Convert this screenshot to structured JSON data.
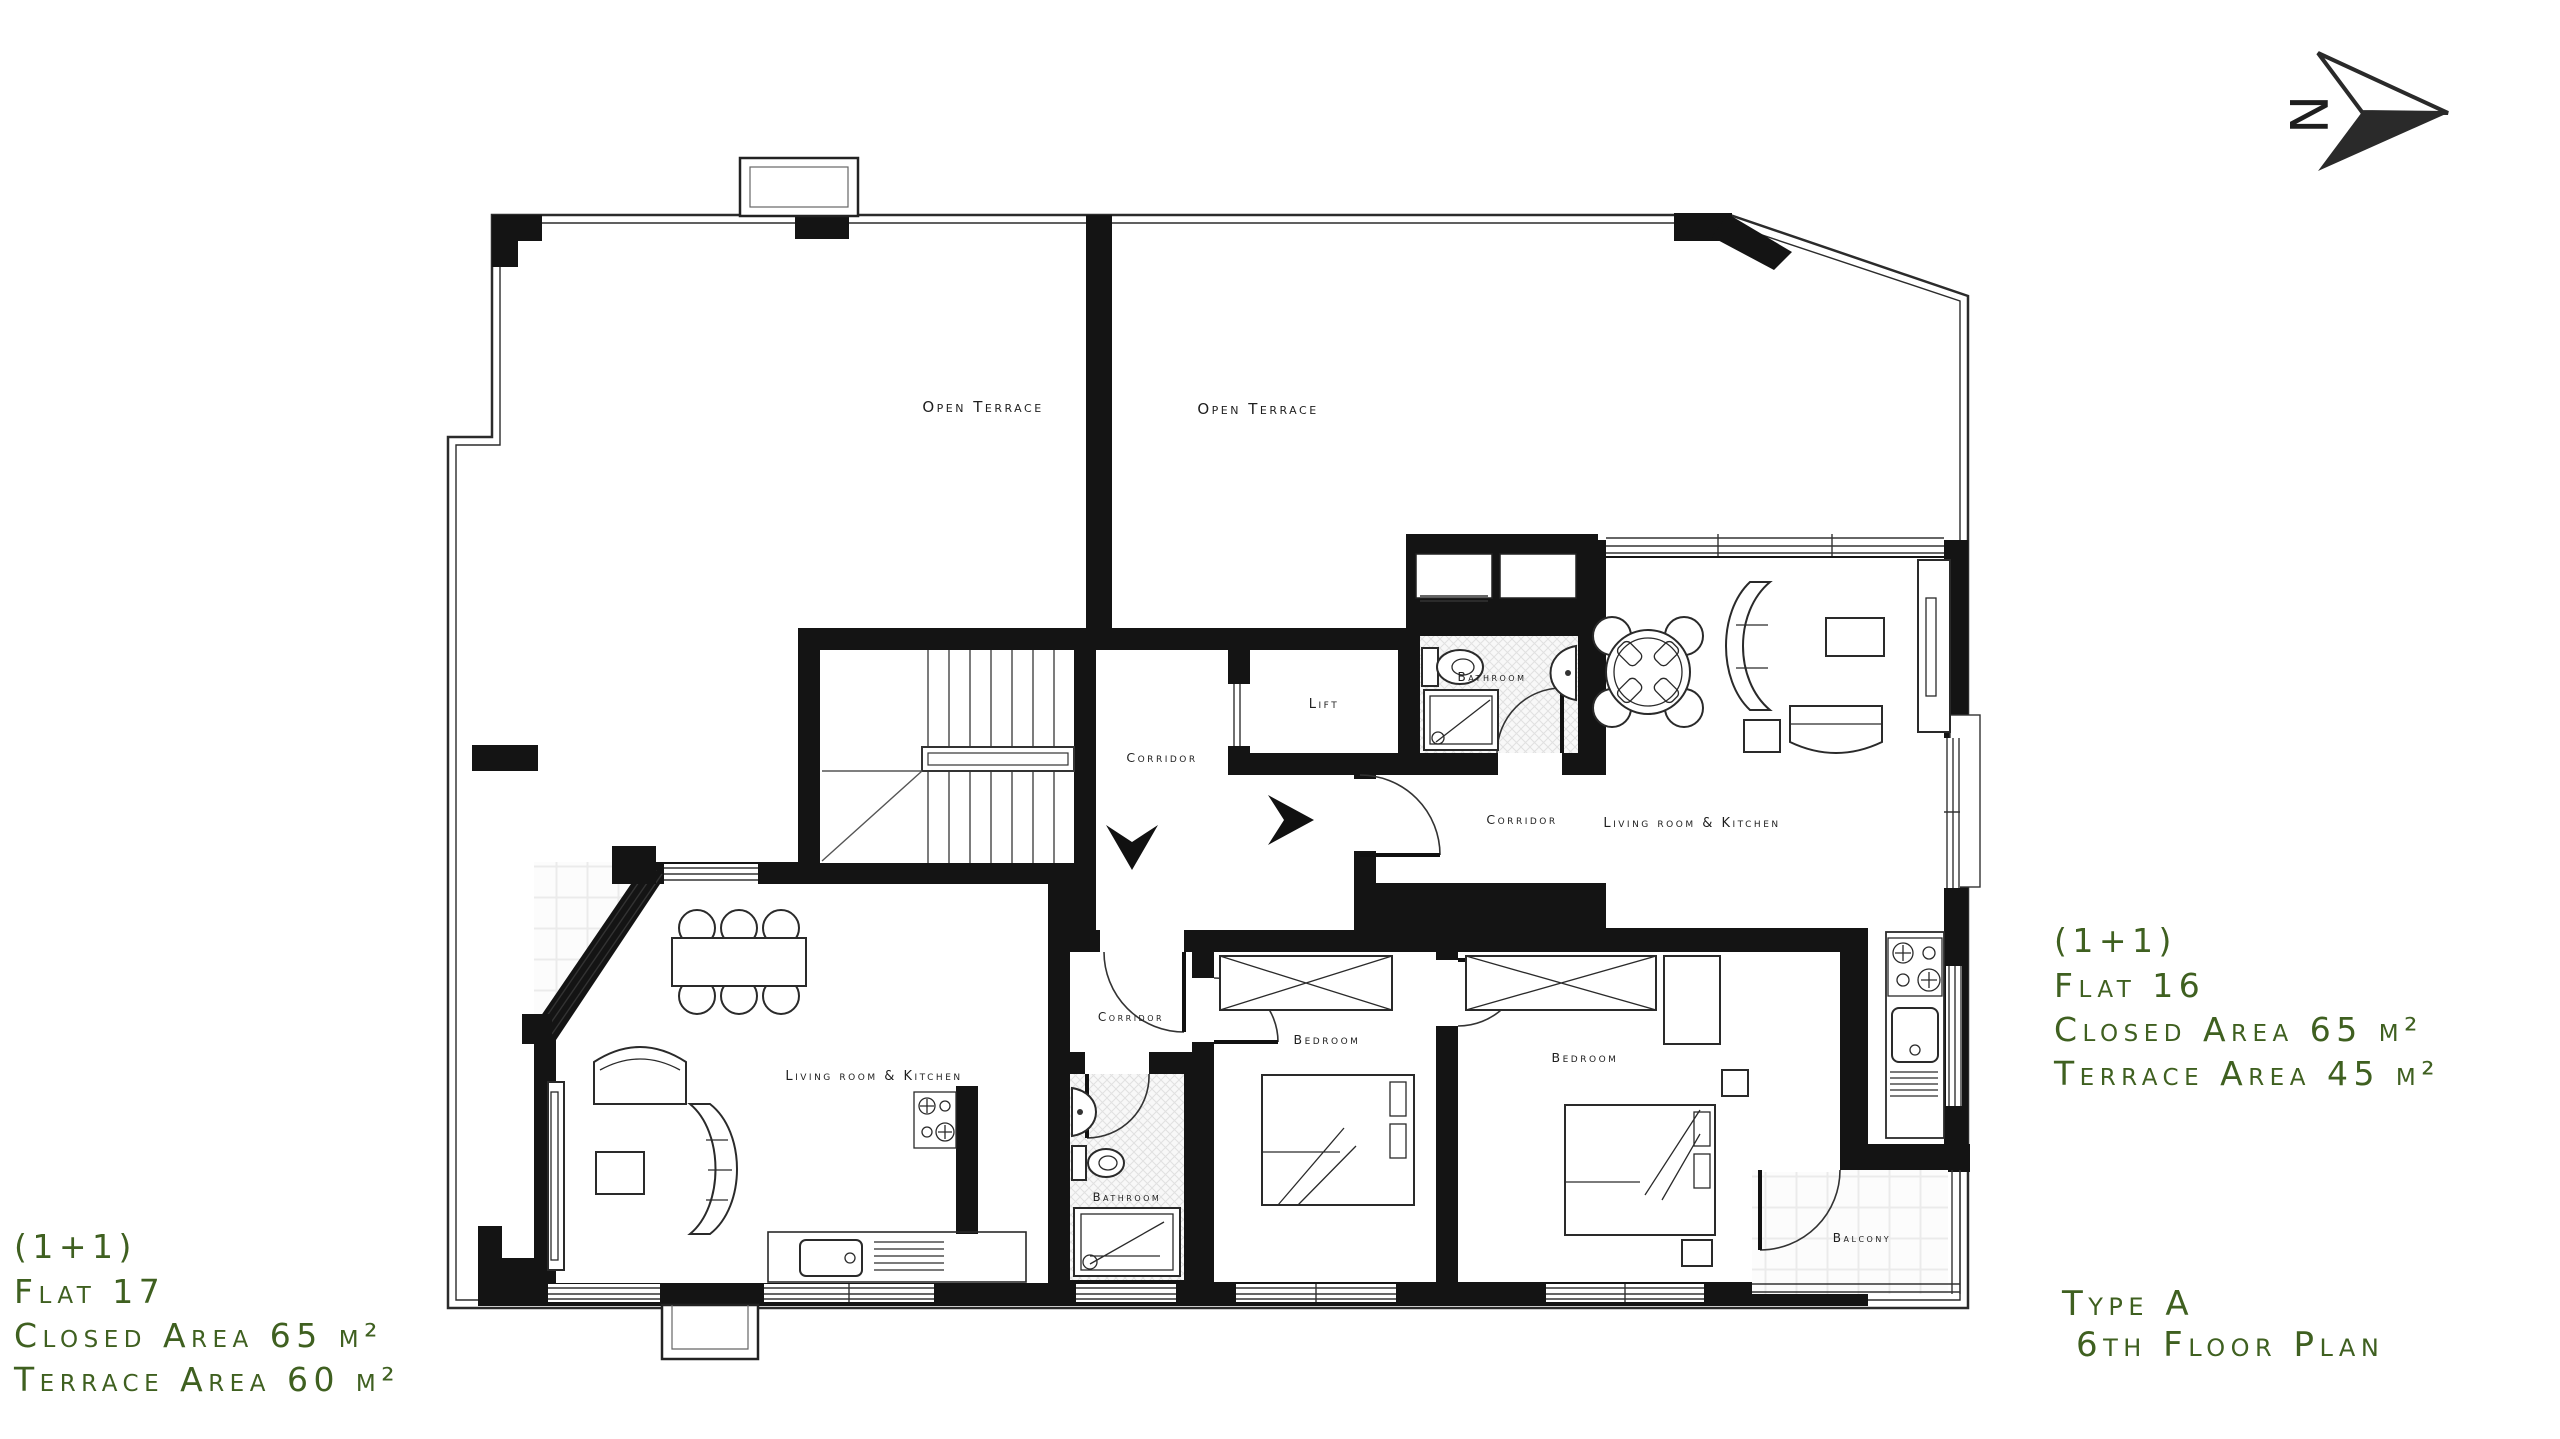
{
  "title": {
    "line1": "Type A",
    "line2": "6th Floor Plan"
  },
  "north": {
    "label": "N"
  },
  "flats": {
    "flat17": {
      "type": "(1+1)",
      "name": "Flat 17",
      "closed_area": "Closed Area 65 m²",
      "terrace_area": "Terrace Area 60 m²"
    },
    "flat16": {
      "type": "(1+1)",
      "name": "Flat 16",
      "closed_area": "Closed Area 65 m²",
      "terrace_area": "Terrace Area 45 m²"
    }
  },
  "rooms": {
    "open_terrace_left": "Open Terrace",
    "open_terrace_right": "Open Terrace",
    "lift": "Lift",
    "corridor_common": "Corridor",
    "bathroom_flat16": "Bathroom",
    "corridor_flat16": "Corridor",
    "living_flat16": "Living room & Kitchen",
    "bedroom_flat16": "Bedroom",
    "balcony": "Balcony",
    "living_flat17": "Living room & Kitchen",
    "corridor_flat17": "Corridor",
    "bathroom_flat17": "Bathroom",
    "bedroom_flat17": "Bedroom"
  },
  "colors": {
    "annotation_green": "#3f6020",
    "wall": "#141414"
  }
}
